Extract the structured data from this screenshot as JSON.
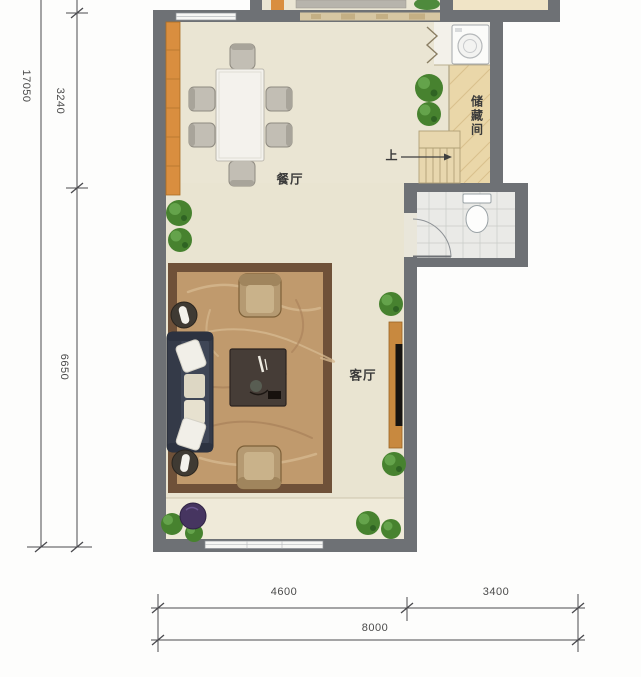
{
  "plan": {
    "rooms": {
      "dining": "餐厅",
      "living": "客厅",
      "storage": "储藏间",
      "stairs_up": "上"
    },
    "dimensions": {
      "total_height": "17050",
      "upper_height": "3240",
      "lower_height": "6650",
      "bottom_left": "4600",
      "bottom_right": "3400",
      "bottom_total": "8000"
    },
    "colors": {
      "wall": "#6e7175",
      "dining_floor": "#eae5d3",
      "living_floor": "#e9e4d1",
      "storage_wood": "#ead7a9",
      "bath_tile": "#eaeae7",
      "rug": "#c09a6d",
      "rug_border": "#6f5139",
      "cabinet_orange": "#d98e3f",
      "sofa": "#343a48",
      "plant_green": "#47822f",
      "dimension_ink": "#4a4a4e"
    },
    "furniture_icons": [
      "dining-table",
      "dining-chair",
      "sideboard-cabinet",
      "washing-machine",
      "folding-door",
      "stairs",
      "toilet",
      "bathroom-door",
      "rug",
      "sofa",
      "throw-pillow",
      "side-table-lamp",
      "coffee-table",
      "armchair",
      "tv-cabinet",
      "tv",
      "potted-plant",
      "bean-bag"
    ]
  }
}
